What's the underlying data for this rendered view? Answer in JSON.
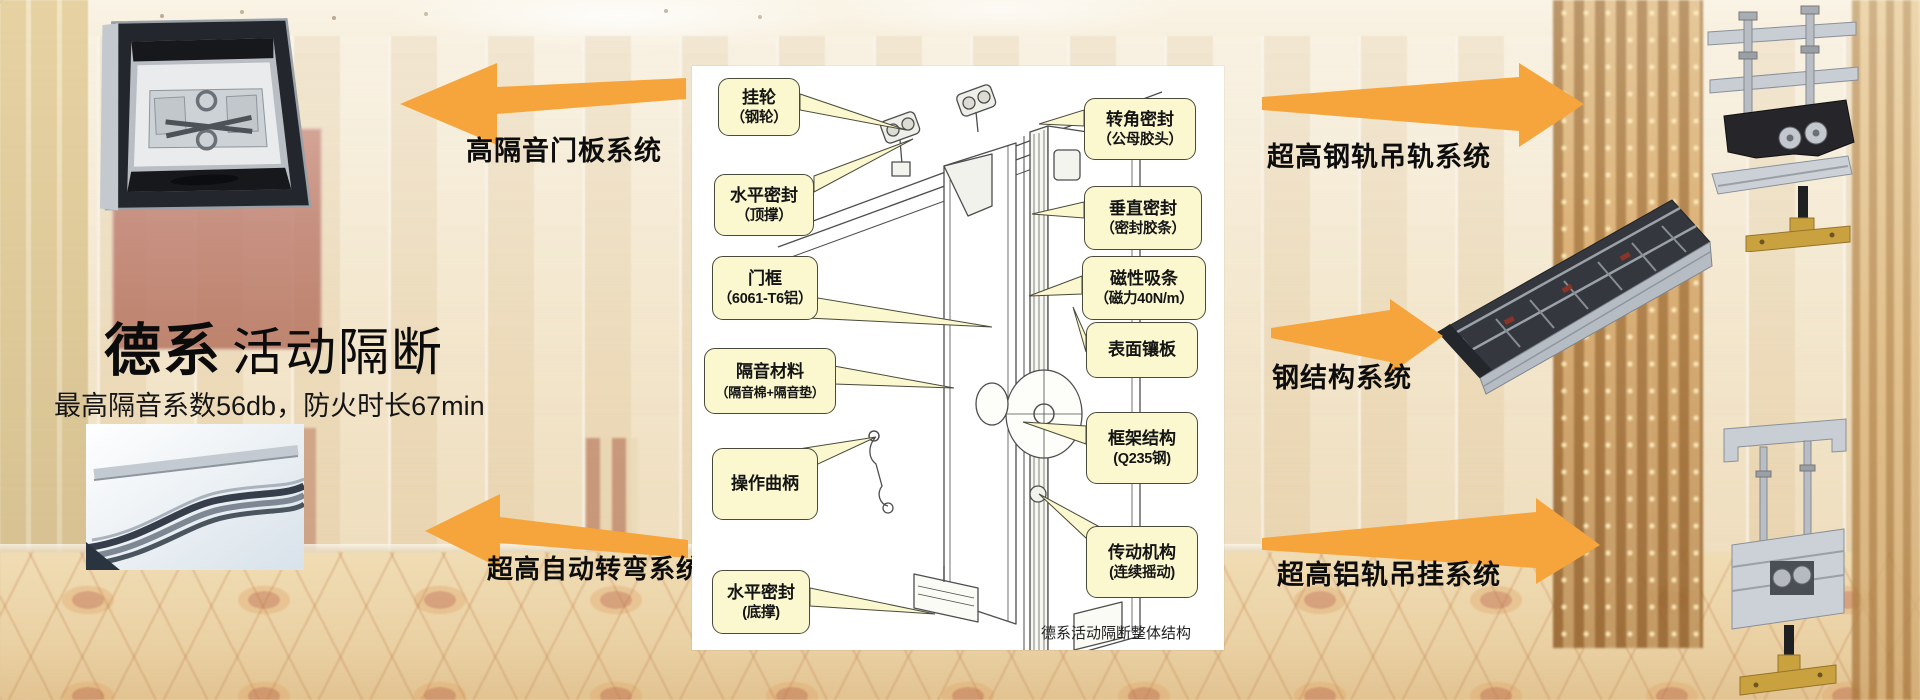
{
  "title": {
    "brand": "德系",
    "name": "活动隔断",
    "subtitle": "最高隔音系数56db，防火时长67min"
  },
  "systems": {
    "door_panel": "高隔音门板系统",
    "auto_turning": "超高自动转弯系统",
    "steel_rail_hanging": "超高钢轨吊轨系统",
    "steel_structure": "钢结构系统",
    "aluminum_rail_hanging": "超高铝轨吊挂系统"
  },
  "diagram": {
    "caption": "德系活动隔断整体结构",
    "callouts": [
      {
        "name": "hanger-wheel",
        "line1": "挂轮",
        "line2": "（钢轮）"
      },
      {
        "name": "horizontal-seal-top",
        "line1": "水平密封",
        "line2": "（顶撑）"
      },
      {
        "name": "door-frame",
        "line1": "门框",
        "line2": "（6061-T6铝）"
      },
      {
        "name": "sound-insulation-material",
        "line1": "隔音材料",
        "line2": "（隔音棉+隔音垫）"
      },
      {
        "name": "operating-crank",
        "line1": "操作曲柄",
        "line2": ""
      },
      {
        "name": "horizontal-seal-bottom",
        "line1": "水平密封",
        "line2": "(底撑)"
      },
      {
        "name": "corner-seal",
        "line1": "转角密封",
        "line2": "（公母胶头）"
      },
      {
        "name": "vertical-seal",
        "line1": "垂直密封",
        "line2": "（密封胶条）"
      },
      {
        "name": "magnetic-strip",
        "line1": "磁性吸条",
        "line2": "（磁力40N/m）"
      },
      {
        "name": "surface-panel",
        "line1": "表面镶板",
        "line2": ""
      },
      {
        "name": "frame-structure",
        "line1": "框架结构",
        "line2": "(Q235钢)"
      },
      {
        "name": "transmission-mechanism",
        "line1": "传动机构",
        "line2": "(连续摇动)"
      }
    ]
  },
  "colors": {
    "arrow_orange": "#F6A53C",
    "callout_fill": "#FBF8CF",
    "callout_border": "#4A4A3B",
    "diagram_bg": "#FFFFFF"
  }
}
